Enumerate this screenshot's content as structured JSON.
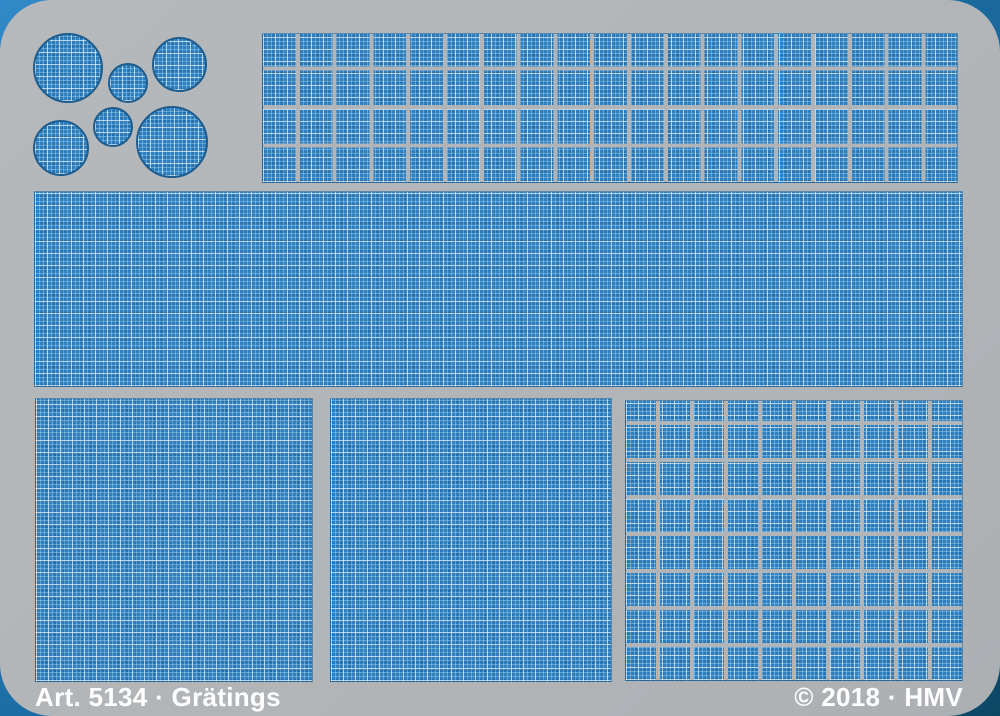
{
  "footer": {
    "article_label": "Art. 5134 · Grätings",
    "copyright_label": "© 2018 · HMV"
  },
  "colors": {
    "backdrop_blue_light": "#3089c6",
    "backdrop_blue_dark": "#0e4766",
    "plate_gray": "#b2b5b8",
    "etch_blue": "#2e80c1",
    "etch_grid_light": "#eaf2f7",
    "outline_blue": "#1d5c8e",
    "label_white": "#ffffff"
  },
  "sheet": {
    "type": "photo-etched brass fret with grating (gräting) parts",
    "pieces": [
      {
        "id": "circular-grating-large",
        "shape": "circle",
        "count": 3
      },
      {
        "id": "circular-grating-small",
        "shape": "circle",
        "count": 3
      },
      {
        "id": "segmented-grating-strip",
        "shape": "grid",
        "columns": 19,
        "rows": 4,
        "count": 1
      },
      {
        "id": "large-grating-sheet",
        "shape": "rectangle",
        "count": 1
      },
      {
        "id": "square-grating-sheet",
        "shape": "rectangle",
        "count": 2
      },
      {
        "id": "segmented-grating-panel",
        "shape": "grid",
        "columns": 10,
        "rows": 8,
        "count": 1
      }
    ]
  }
}
